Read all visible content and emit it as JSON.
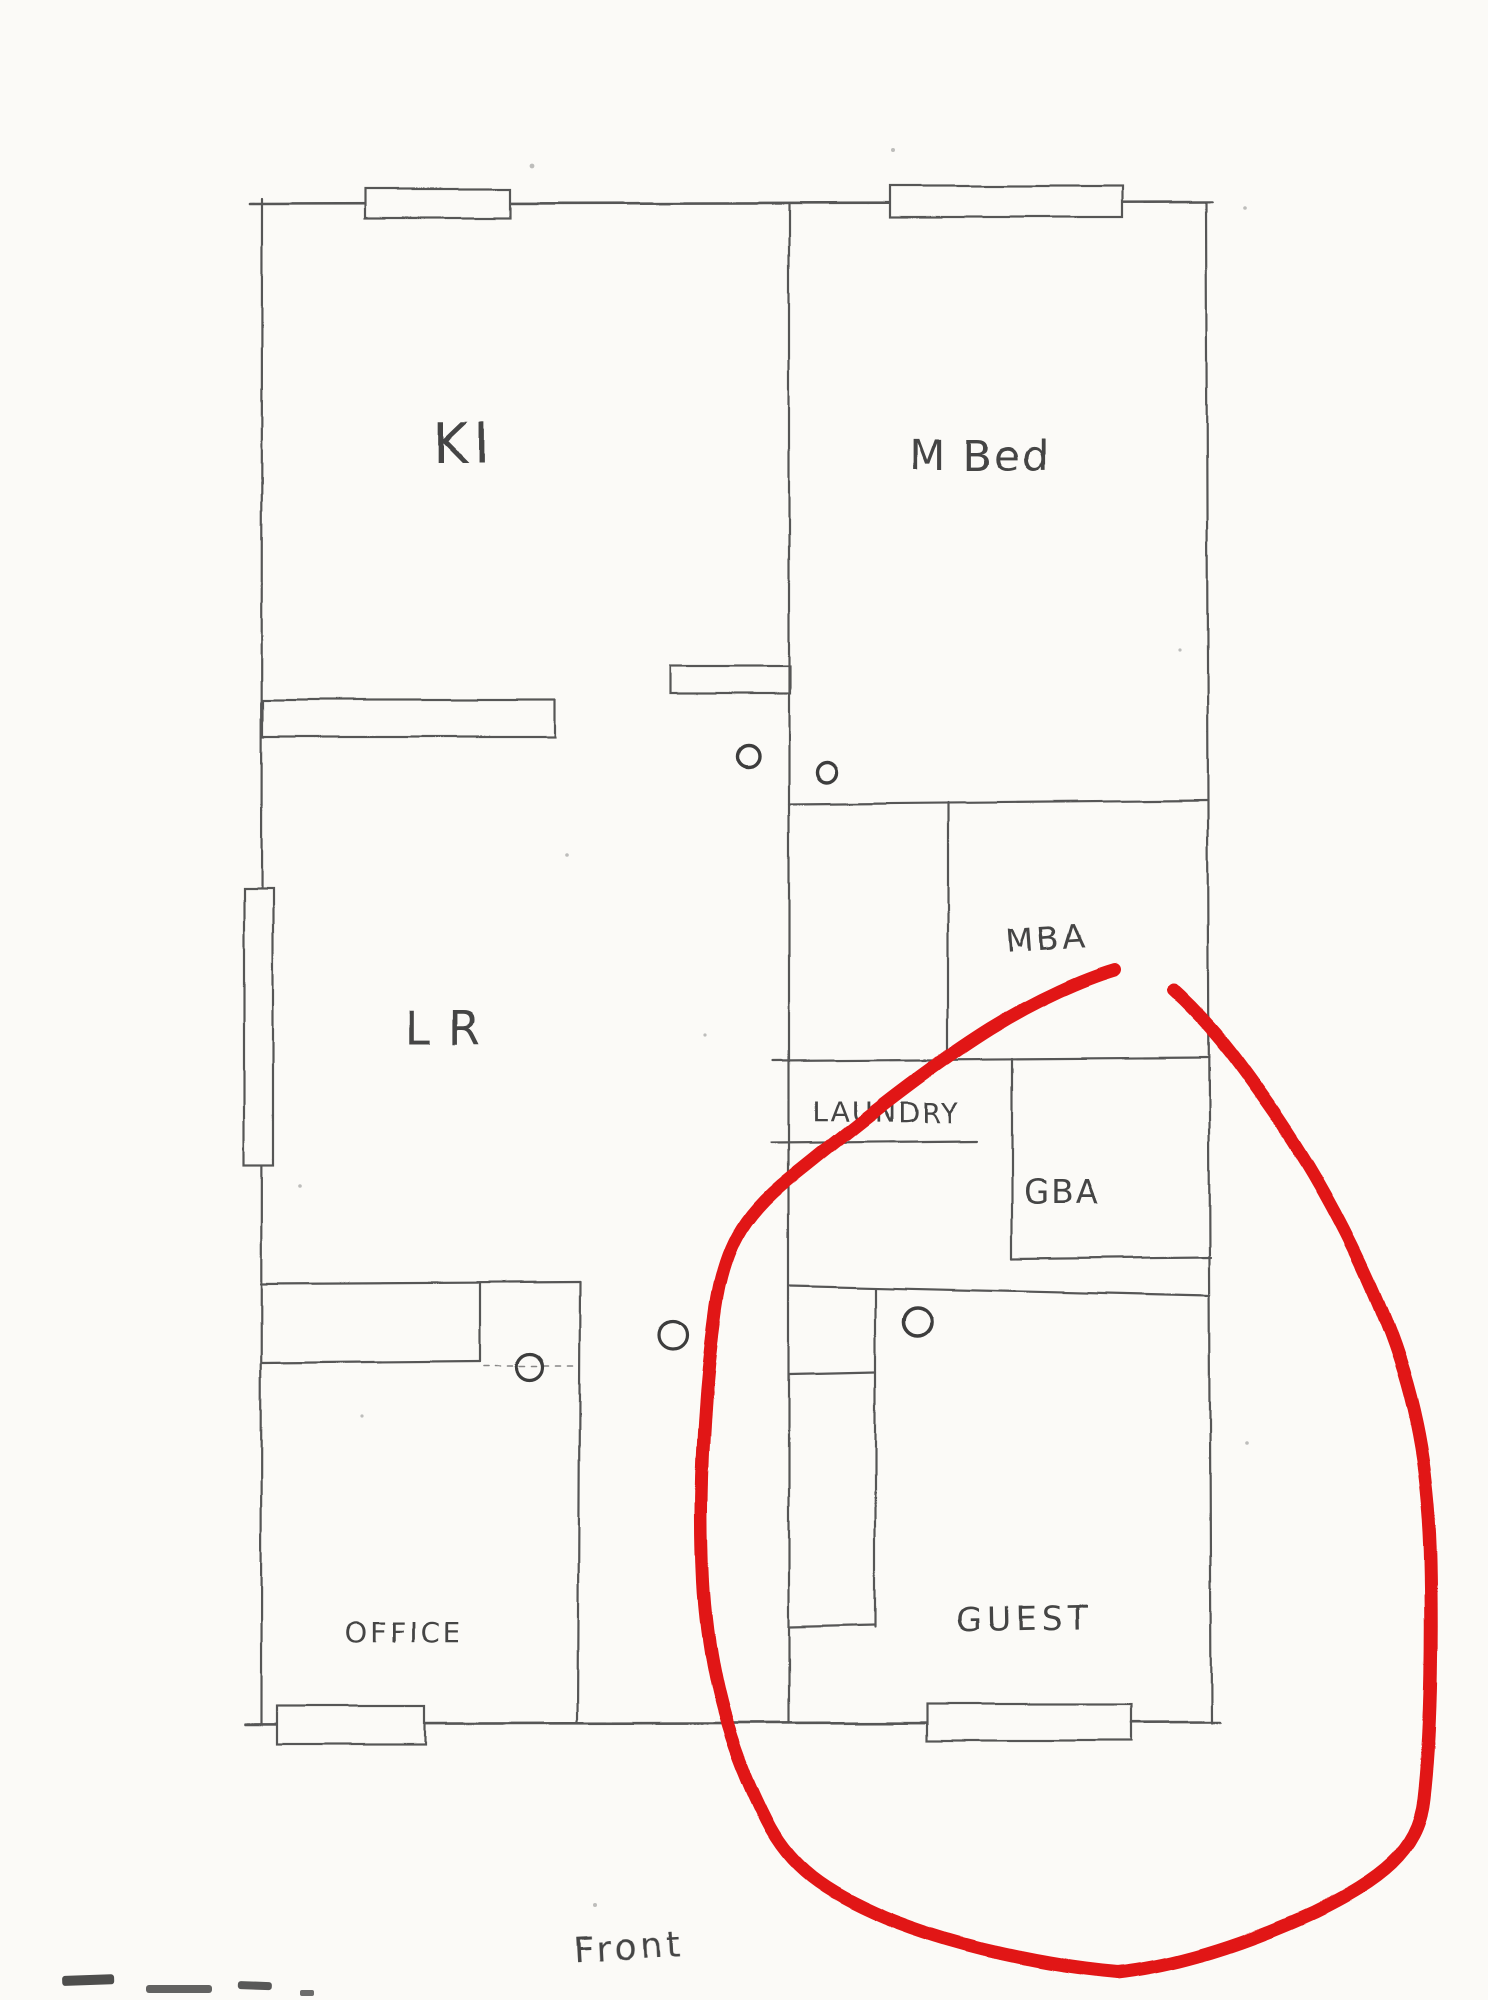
{
  "document": {
    "kind": "hand-drawn floor plan sketch",
    "front_label": "Front"
  },
  "colors": {
    "paper": "#fbfaf7",
    "pencil": "#565656",
    "annotation_red": "#e11414"
  },
  "rooms": {
    "kitchen": {
      "label": "KI"
    },
    "master_bedroom": {
      "label": "M Bed"
    },
    "living_room": {
      "label": "LR"
    },
    "master_bath": {
      "label": "MBA"
    },
    "laundry": {
      "label": "LAUNDRY"
    },
    "guest_bath": {
      "label": "GBA"
    },
    "office": {
      "label": "OFFICE"
    },
    "guest_bedroom": {
      "label": "GUEST"
    }
  },
  "annotation": {
    "shape": "hand-drawn red ellipse",
    "around": "GUEST"
  }
}
